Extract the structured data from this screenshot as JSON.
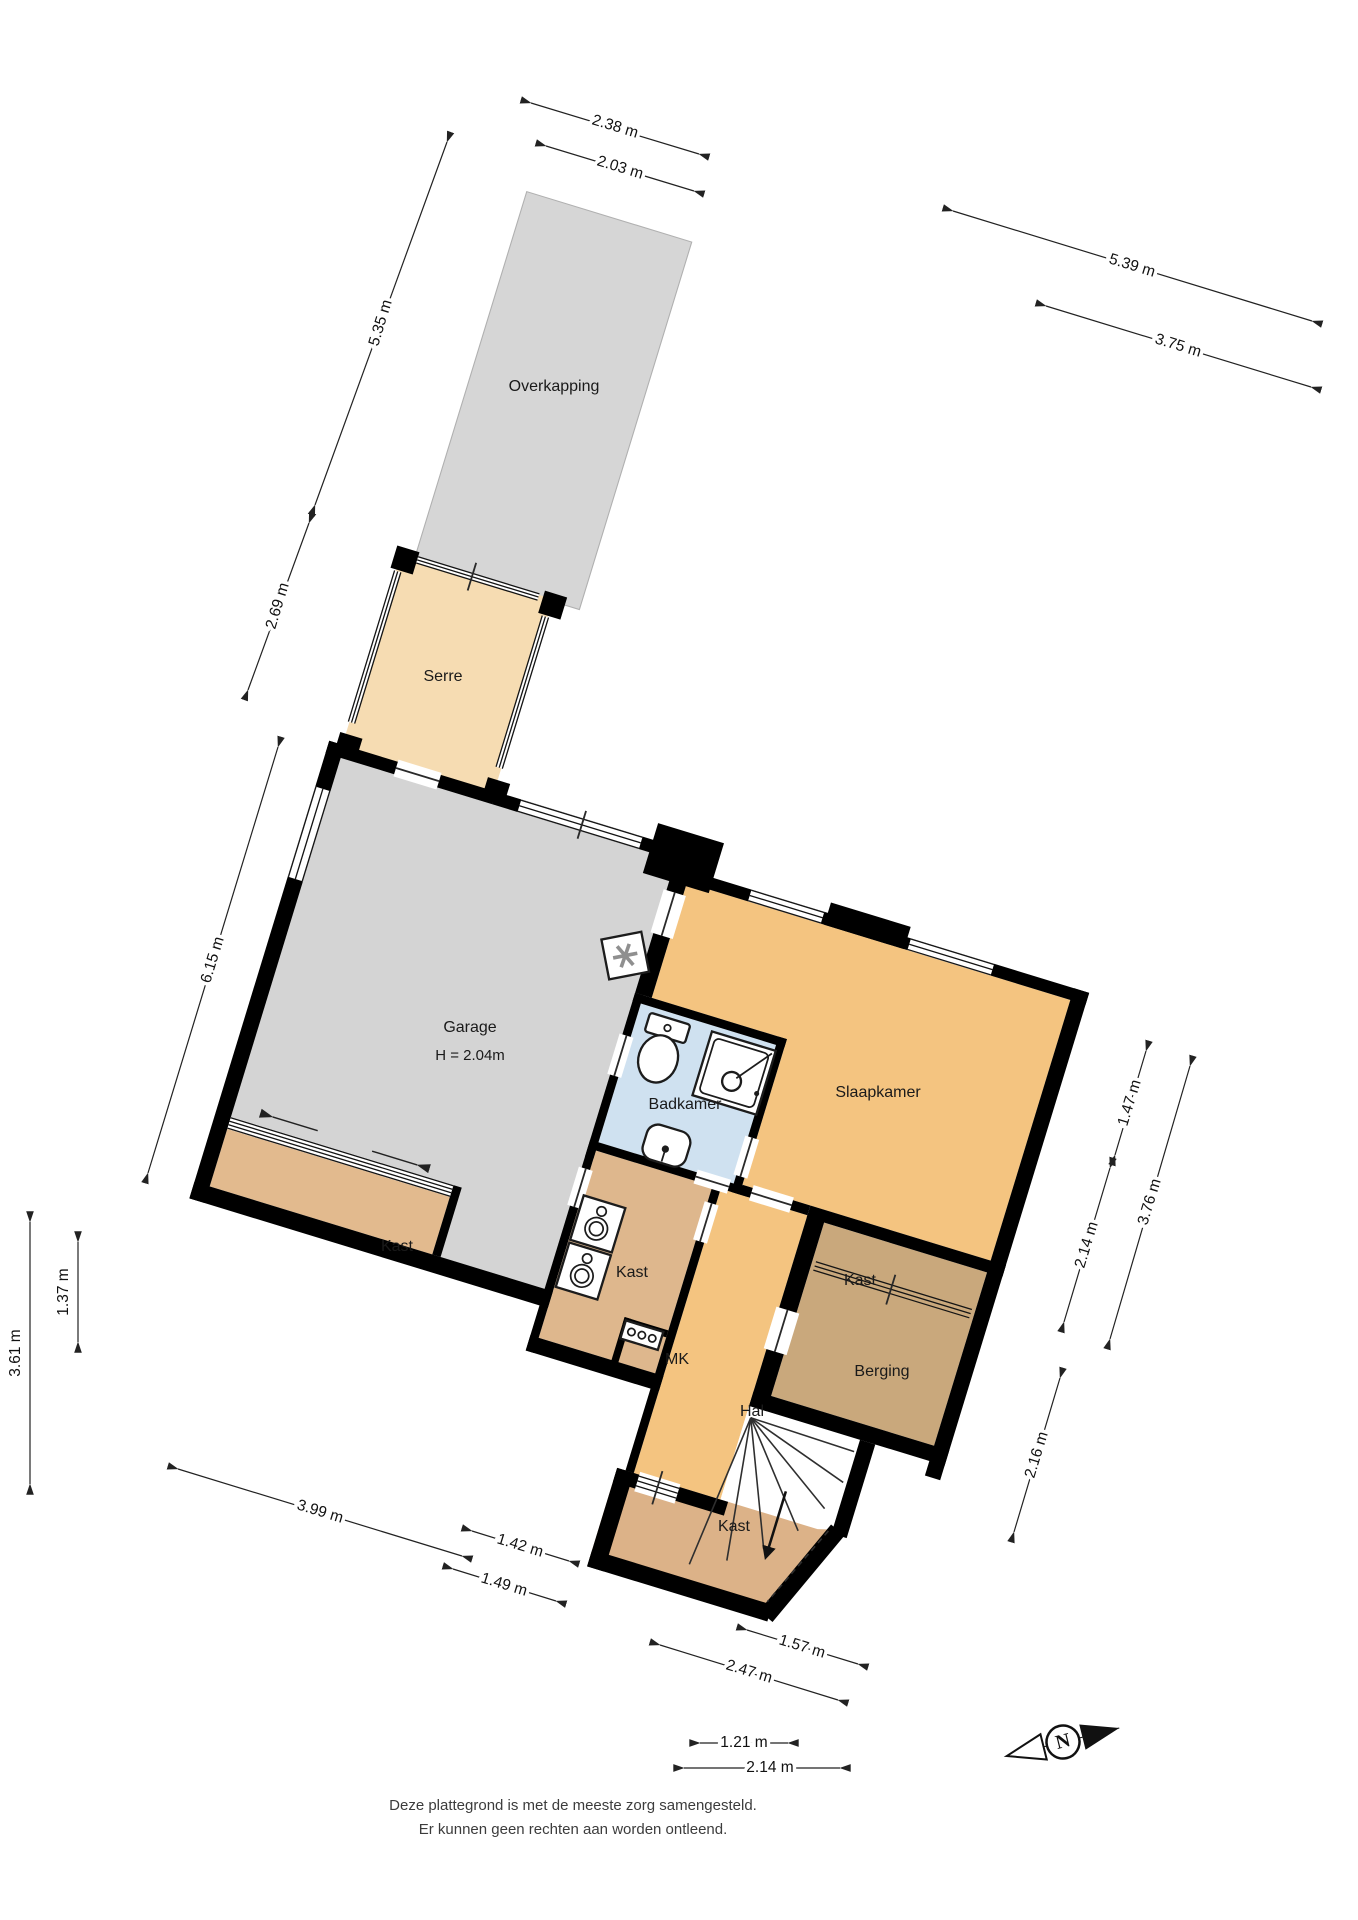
{
  "rooms": {
    "overkapping": {
      "label": "Overkapping",
      "x": 554,
      "y": 387
    },
    "serre": {
      "label": "Serre",
      "x": 443,
      "y": 677
    },
    "garage": {
      "label": "Garage",
      "sublabel": "H = 2.04m",
      "x": 470,
      "y": 1028,
      "sub_y": 1056
    },
    "badkamer": {
      "label": "Badkamer",
      "x": 685,
      "y": 1105
    },
    "slaapkamer": {
      "label": "Slaapkamer",
      "x": 878,
      "y": 1093
    },
    "kast_left": {
      "label": "Kast",
      "x": 397,
      "y": 1247
    },
    "kast_mid": {
      "label": "Kast",
      "x": 632,
      "y": 1273
    },
    "mk": {
      "label": "MK",
      "x": 677,
      "y": 1360
    },
    "hal": {
      "label": "Hal",
      "x": 752,
      "y": 1412
    },
    "kast_right": {
      "label": "Kast",
      "x": 860,
      "y": 1281
    },
    "berging": {
      "label": "Berging",
      "x": 882,
      "y": 1372
    },
    "kast_bottom": {
      "label": "Kast",
      "x": 734,
      "y": 1527
    }
  },
  "dimensions": [
    {
      "label": "2.38 m",
      "x1": 531,
      "y1": 103,
      "x2": 699,
      "y2": 154,
      "tx": 615,
      "ty": 127,
      "angle": 17
    },
    {
      "label": "2.03 m",
      "x1": 546,
      "y1": 146,
      "x2": 694,
      "y2": 191,
      "tx": 620,
      "ty": 168,
      "angle": 17
    },
    {
      "label": "5.39 m",
      "x1": 953,
      "y1": 211,
      "x2": 1312,
      "y2": 321,
      "tx": 1132,
      "ty": 266,
      "angle": 17
    },
    {
      "label": "3.75 m",
      "x1": 1046,
      "y1": 306,
      "x2": 1311,
      "y2": 387,
      "tx": 1178,
      "ty": 346,
      "angle": 17
    },
    {
      "label": "5.35 m",
      "x1": 447,
      "y1": 142,
      "x2": 315,
      "y2": 505,
      "tx": 381,
      "ty": 323,
      "angle": -73
    },
    {
      "label": "2.69 m",
      "x1": 309,
      "y1": 523,
      "x2": 248,
      "y2": 690,
      "tx": 278,
      "ty": 606,
      "angle": -73
    },
    {
      "label": "6.15 m",
      "x1": 278,
      "y1": 747,
      "x2": 148,
      "y2": 1173,
      "tx": 213,
      "ty": 960,
      "angle": -73
    },
    {
      "label": "1.37 m",
      "x1": 78,
      "y1": 1242,
      "x2": 78,
      "y2": 1342,
      "tx": 64,
      "ty": 1292,
      "angle": -90
    },
    {
      "label": "3.61 m",
      "x1": 30,
      "y1": 1222,
      "x2": 30,
      "y2": 1484,
      "tx": 16,
      "ty": 1353,
      "angle": -90
    },
    {
      "label": "1.47 m",
      "x1": 1146,
      "y1": 1051,
      "x2": 1115,
      "y2": 1155,
      "tx": 1130,
      "ty": 1103,
      "angle": -73
    },
    {
      "label": "2.14 m",
      "x1": 1110,
      "y1": 1168,
      "x2": 1064,
      "y2": 1322,
      "tx": 1087,
      "ty": 1245,
      "angle": -73
    },
    {
      "label": "3.76 m",
      "x1": 1190,
      "y1": 1066,
      "x2": 1110,
      "y2": 1339,
      "tx": 1150,
      "ty": 1202,
      "angle": -73
    },
    {
      "label": "2.16 m",
      "x1": 1060,
      "y1": 1378,
      "x2": 1014,
      "y2": 1532,
      "tx": 1037,
      "ty": 1455,
      "angle": -73
    },
    {
      "label": "3.99 m",
      "x1": 178,
      "y1": 1469,
      "x2": 462,
      "y2": 1556,
      "tx": 320,
      "ty": 1512,
      "angle": 17
    },
    {
      "label": "1.42 m",
      "x1": 472,
      "y1": 1531,
      "x2": 569,
      "y2": 1561,
      "tx": 520,
      "ty": 1546,
      "angle": 17
    },
    {
      "label": "1.49 m",
      "x1": 453,
      "y1": 1569,
      "x2": 556,
      "y2": 1601,
      "tx": 504,
      "ty": 1585,
      "angle": 17
    },
    {
      "label": "1.57 m",
      "x1": 747,
      "y1": 1630,
      "x2": 858,
      "y2": 1664,
      "tx": 802,
      "ty": 1647,
      "angle": 17
    },
    {
      "label": "2.47 m",
      "x1": 660,
      "y1": 1645,
      "x2": 838,
      "y2": 1700,
      "tx": 749,
      "ty": 1672,
      "angle": 17
    },
    {
      "label": "1.21 m",
      "x1": 700,
      "y1": 1743,
      "x2": 788,
      "y2": 1743,
      "tx": 744,
      "ty": 1743,
      "angle": 0
    },
    {
      "label": "2.14 m",
      "x1": 684,
      "y1": 1768,
      "x2": 840,
      "y2": 1768,
      "tx": 770,
      "ty": 1768,
      "angle": 0
    }
  ],
  "footer": {
    "line1": "Deze plattegrond is met de meeste zorg samengesteld.",
    "line2": "Er kunnen geen rechten aan worden ontleend."
  },
  "compass": {
    "letter": "N"
  },
  "icons": [
    "toilet-icon",
    "shower-icon",
    "sink-icon",
    "boiler-icon",
    "washer-icon",
    "meter-panel-icon",
    "stairs-icon",
    "north-arrow-icon"
  ],
  "colors": {
    "wall": "#000000",
    "garage_floor": "#d4d4d4",
    "overkapping": "#d6d6d6",
    "serre": "#f6dcb2",
    "slaapkamer_hal": "#f4c480",
    "kast": "#e2ba8e",
    "kast_mid": "#deb78d",
    "berging": "#c9a87c",
    "badkamer": "#cfe1f0",
    "dimension": "#222222"
  }
}
